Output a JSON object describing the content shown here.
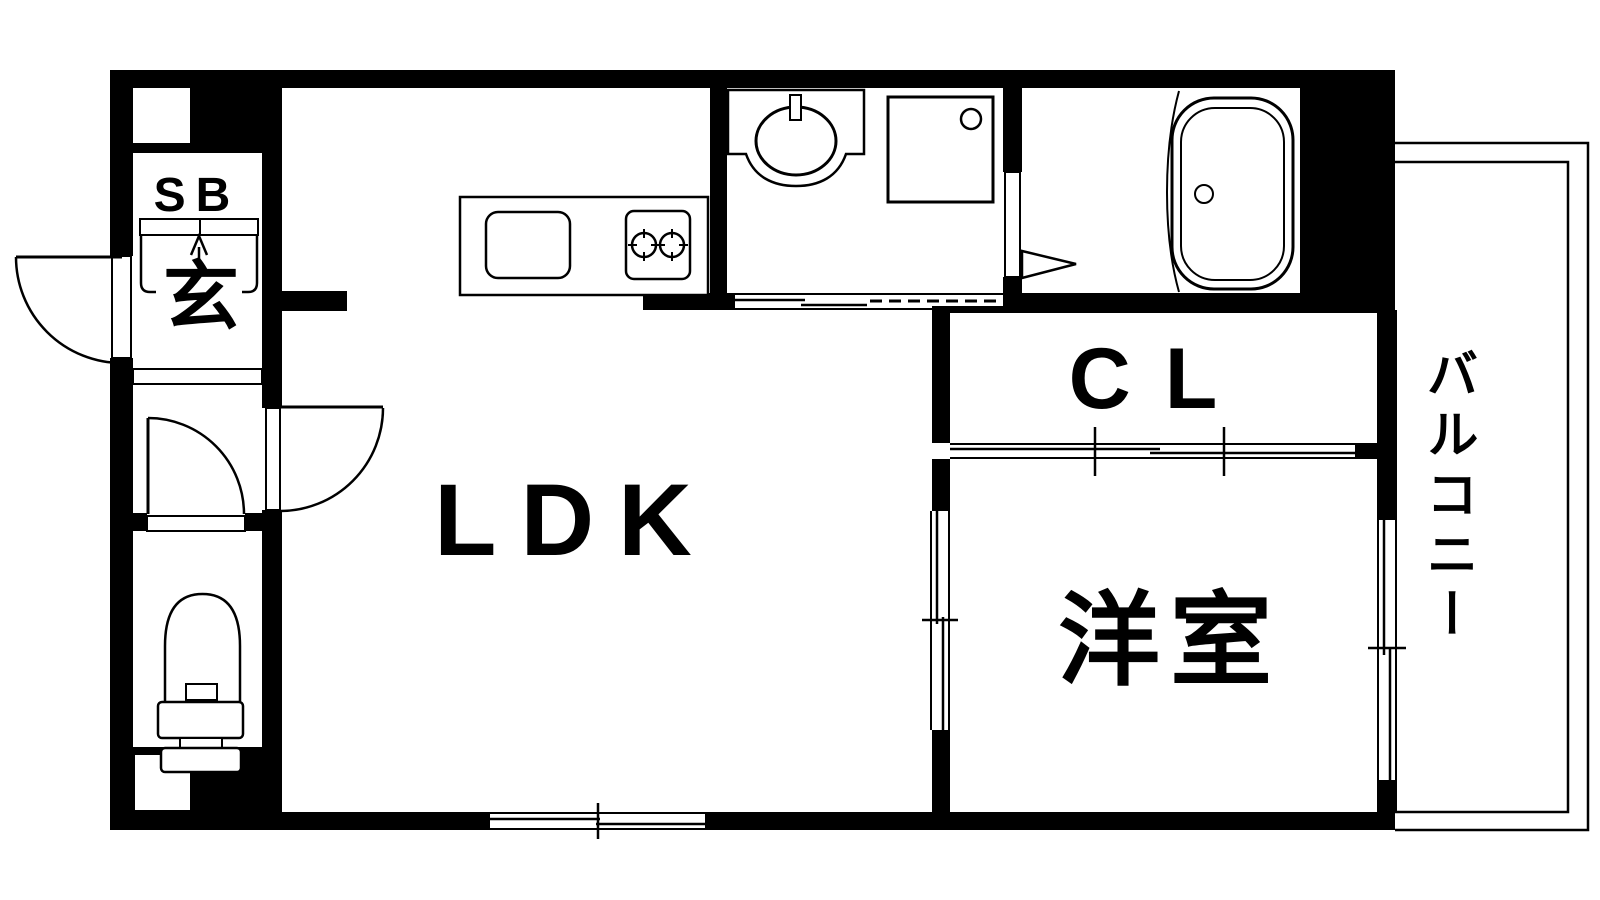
{
  "plan": {
    "title": "apartment-floor-plan",
    "rooms": {
      "ldk": "LDK",
      "western_room": "洋室",
      "closet": "CL",
      "entrance": "玄",
      "shoe_box": "SB",
      "balcony": "バルコニー"
    },
    "colors": {
      "wall": "#000000",
      "floor": "#ffffff",
      "line": "#000000"
    }
  }
}
